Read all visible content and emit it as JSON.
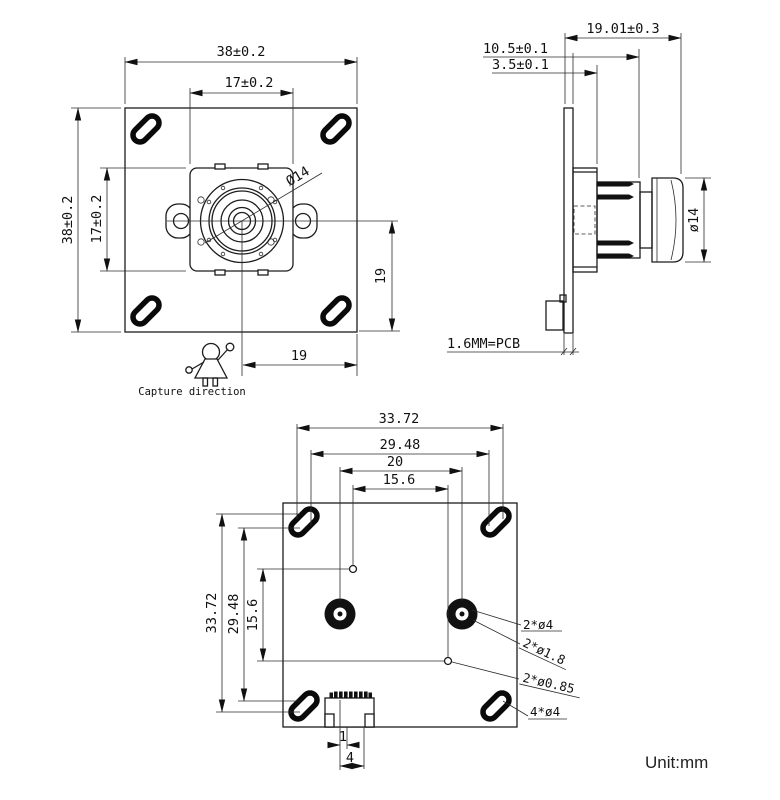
{
  "colors": {
    "line": "#1c1c1c",
    "background": "#ffffff"
  },
  "front": {
    "top_outer": "38±0.2",
    "top_inner": "17±0.2",
    "left_outer": "38±0.2",
    "left_inner": "17±0.2",
    "lens_dia": "Ø14",
    "right_offset": "19",
    "bottom_offset": "19",
    "capture_label": "Capture direction"
  },
  "side": {
    "total_depth": "19.01±0.3",
    "lens_depth": "10.5±0.1",
    "holder_depth": "3.5±0.1",
    "lens_dia": "ø14",
    "pcb_label": "1.6MM=PCB"
  },
  "back": {
    "h_outer": "33.72",
    "h_slot": "29.48",
    "h_holes": "20",
    "h_small": "15.6",
    "v_outer": "33.72",
    "v_slot": "29.48",
    "v_small": "15.6",
    "callout_big_holes": "2*ø4",
    "callout_mid_holes": "2*ø1.8",
    "callout_small_holes": "2*ø0.85",
    "callout_slots": "4*ø4",
    "pin_pitch": "1",
    "connector_width": "4"
  },
  "footer": {
    "unit": "Unit:mm"
  }
}
